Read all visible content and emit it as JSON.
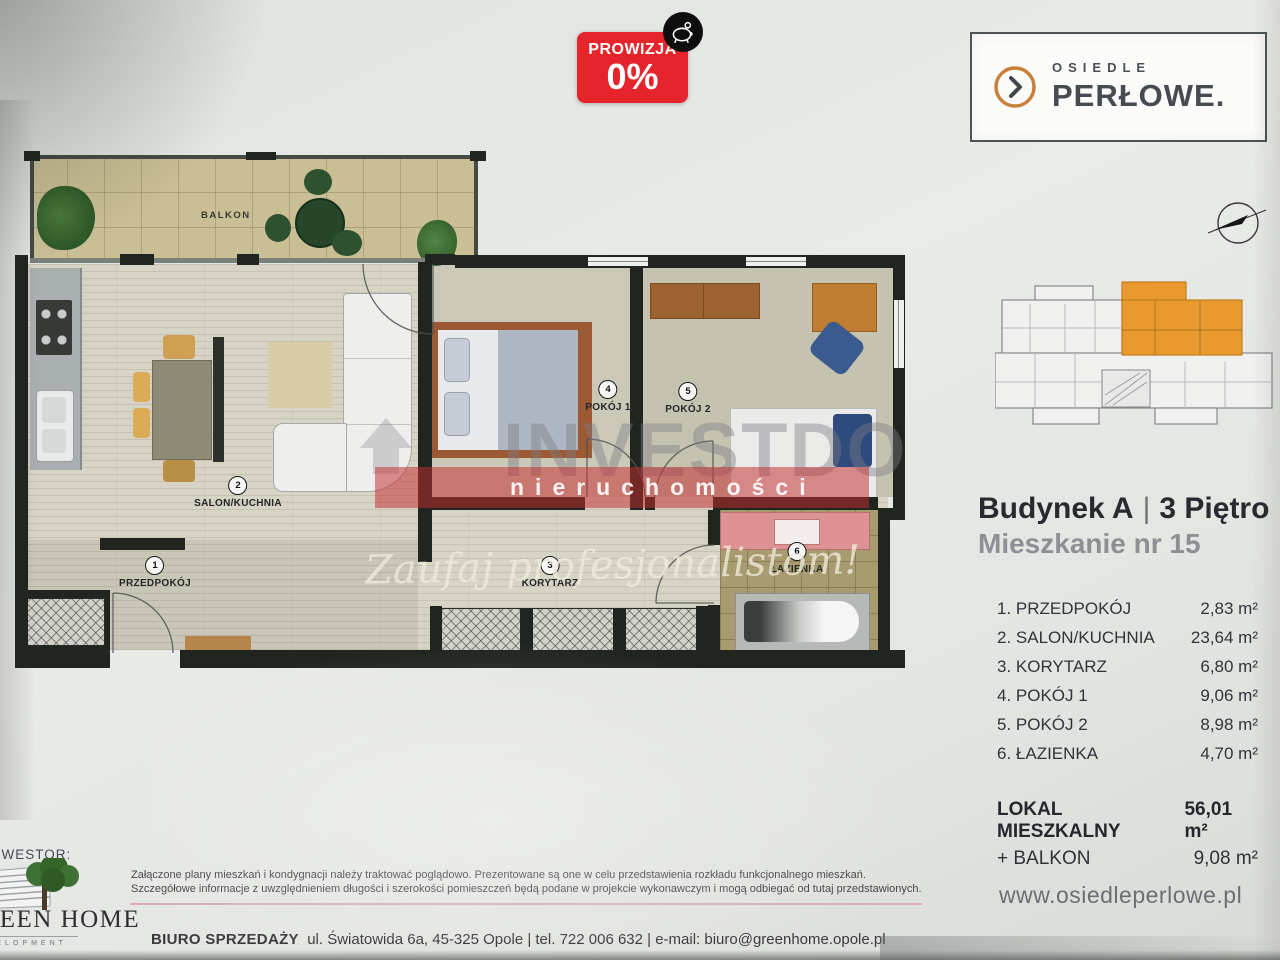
{
  "badge": {
    "label": "PROWIZJA",
    "value": "0%"
  },
  "logo": {
    "top": "OSIEDLE",
    "name": "PERŁOWE."
  },
  "plan": {
    "balcony_label": "BALKON",
    "rooms": [
      {
        "num": "1",
        "name": "PRZEDPOKÓJ"
      },
      {
        "num": "2",
        "name": "SALON/KUCHNIA"
      },
      {
        "num": "3",
        "name": "KORYTARZ"
      },
      {
        "num": "4",
        "name": "POKÓJ 1"
      },
      {
        "num": "5",
        "name": "POKÓJ 2"
      },
      {
        "num": "6",
        "name": "ŁAZIENKA"
      }
    ]
  },
  "watermark": {
    "brand": "INVESTDOM",
    "subtitle": "nieruchomości",
    "script": "Zaufaj profesjonalistom!"
  },
  "sidebar": {
    "building": "Budynek A",
    "divider": "|",
    "floor": "3 Piętro",
    "apartment": "Mieszkanie nr 15",
    "rooms": [
      {
        "label": "1. PRZEDPOKÓJ",
        "area": "2,83 m²"
      },
      {
        "label": "2. SALON/KUCHNIA",
        "area": "23,64 m²"
      },
      {
        "label": "3. KORYTARZ",
        "area": "6,80 m²"
      },
      {
        "label": "4. POKÓJ 1",
        "area": "9,06 m²"
      },
      {
        "label": "5. POKÓJ 2",
        "area": "8,98 m²"
      },
      {
        "label": "6. ŁAZIENKA",
        "area": "4,70 m²"
      }
    ],
    "totals": [
      {
        "label": "LOKAL MIESZKALNY",
        "area": "56,01 m²"
      },
      {
        "label": "+ BALKON",
        "area": "9,08 m²"
      }
    ],
    "website": "www.osiedleperlowe.pl"
  },
  "footer": {
    "investor_label": "INWESTOR:",
    "investor_name": "GREEN HOME",
    "investor_subtitle": "DEVELOPMENT",
    "disclaimer_line1": "Załączone plany mieszkań i kondygnacji należy traktować poglądowo. Prezentowane są one w celu przedstawienia rozkładu funkcjonalnego mieszkań.",
    "disclaimer_line2": "Szczegółowe informacje z uwzględnieniem długości i szerokości pomieszczeń będą podane w projekcie wykonawczym i mogą odbiegać od tutaj przedstawionych.",
    "office_label": "BIURO SPRZEDAŻY",
    "office_info": "ul. Światowida 6a, 45-325 Opole  |  tel. 722 006 632  |  e-mail: biuro@greenhome.opole.pl"
  },
  "colors": {
    "accent_red": "#e6242b",
    "accent_orange": "#d98f3e",
    "highlight_orange": "#e89a2e",
    "wall_dark": "#20261f"
  }
}
